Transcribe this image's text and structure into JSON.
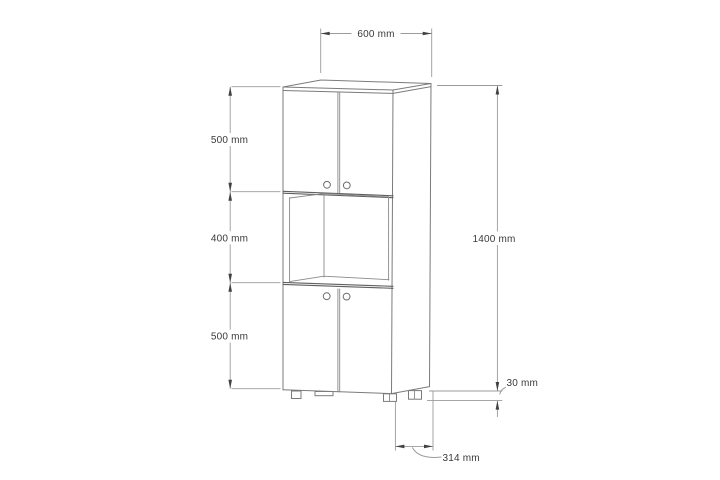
{
  "drawing": {
    "labels": {
      "width": "600 mm",
      "top_section": "500 mm",
      "middle_section": "400 mm",
      "bottom_section": "500 mm",
      "height": "1400 mm",
      "foot": "30 mm",
      "depth": "314 mm"
    },
    "colors": {
      "outline": "#7b7b7b",
      "dark_outline": "#5f5f5f",
      "dimension_line": "#9b9b9b",
      "arrow": "#414141",
      "text": "#3a3a3a",
      "background": "#ffffff"
    }
  }
}
